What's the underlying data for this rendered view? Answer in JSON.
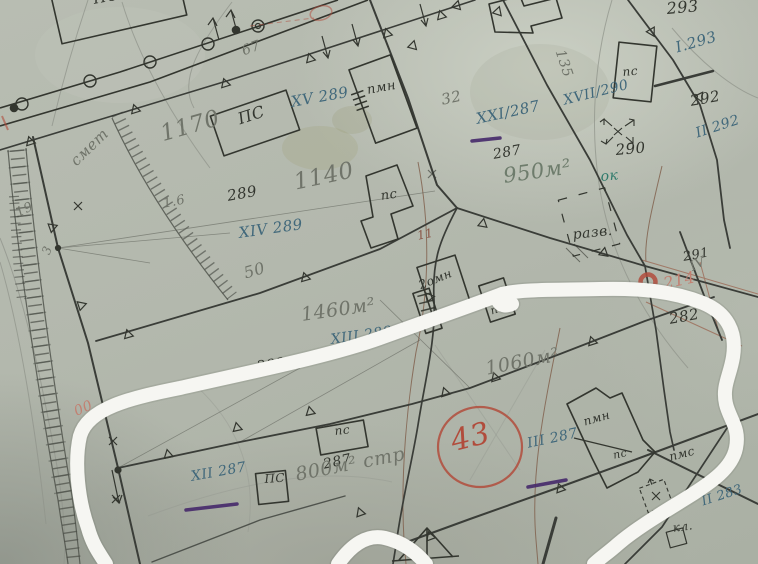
{
  "map": {
    "title": "scanned hand-drawn cadastral plan",
    "paper_color": "#b4bab0",
    "ink_color": "#33362f",
    "blue_ink_color": "#41687b",
    "pencil_color": "#70746a",
    "red_color": "#b14c3c",
    "purple_color": "#46296b",
    "teal_color": "#2f7a6b",
    "highlight": {
      "type": "freehand-marker-loop",
      "color": "white"
    },
    "black_labels": [
      {
        "text": "ПС"
      },
      {
        "text": "ПС"
      },
      {
        "text": "пмн"
      },
      {
        "text": "пс"
      },
      {
        "text": "пс"
      },
      {
        "text": "293"
      },
      {
        "text": "292"
      },
      {
        "text": "290"
      },
      {
        "text": "287"
      },
      {
        "text": "289"
      },
      {
        "text": "291"
      },
      {
        "text": "282"
      },
      {
        "text": "288"
      },
      {
        "text": "287"
      },
      {
        "text": "разв."
      },
      {
        "text": "2омн"
      },
      {
        "text": "пс"
      },
      {
        "text": "ПС"
      },
      {
        "text": "пс"
      },
      {
        "text": "пмн"
      },
      {
        "text": "пс"
      },
      {
        "text": "пмс"
      },
      {
        "text": "кл."
      }
    ],
    "blue_labels": [
      {
        "text": "XV 289"
      },
      {
        "text": "XIV 289"
      },
      {
        "text": "XXI/287"
      },
      {
        "text": "XVII/290"
      },
      {
        "text": "I.293"
      },
      {
        "text": "II 292"
      },
      {
        "text": "XIII 288"
      },
      {
        "text": "XII 287"
      },
      {
        "text": "III 287"
      },
      {
        "text": "II 283"
      }
    ],
    "teal_labels": [
      {
        "text": "ок"
      }
    ],
    "pencil_labels": [
      {
        "text": "1170"
      },
      {
        "text": "1140"
      },
      {
        "text": "950м²"
      },
      {
        "text": "1460м²"
      },
      {
        "text": "1060м²"
      },
      {
        "text": "800м² стр"
      },
      {
        "text": "смет"
      },
      {
        "text": "67"
      },
      {
        "text": "32"
      },
      {
        "text": "135"
      },
      {
        "text": "50"
      },
      {
        "text": "1.6"
      },
      {
        "text": "19"
      },
      {
        "text": "3"
      },
      {
        "text": "3"
      },
      {
        "text": "IV"
      },
      {
        "text": "11"
      }
    ],
    "red_labels": [
      {
        "text": "43"
      },
      {
        "text": "214"
      },
      {
        "text": "00"
      }
    ]
  }
}
